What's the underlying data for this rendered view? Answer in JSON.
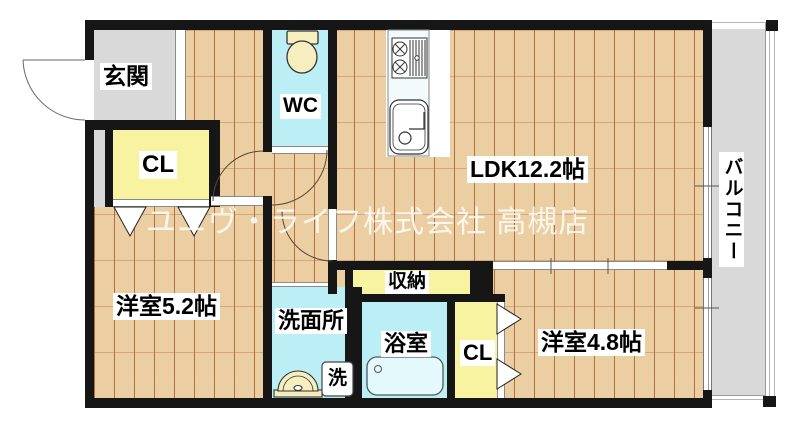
{
  "floorplan": {
    "type": "apartment-floor-plan",
    "watermark": "ユニヴ・ライフ株式会社 高槻店",
    "rooms": {
      "genkan": {
        "label": "玄関",
        "floor": "gray"
      },
      "wc": {
        "label": "WC",
        "floor": "cyan"
      },
      "ldk": {
        "label": "LDK12.2帖",
        "floor": "wood"
      },
      "closet1": {
        "label": "CL",
        "floor": "yellow"
      },
      "western_room1": {
        "label": "洋室5.2帖",
        "floor": "wood"
      },
      "storage": {
        "label": "収納",
        "floor": "yellow"
      },
      "senmenjo": {
        "label": "洗面所",
        "floor": "cyan"
      },
      "bathroom": {
        "label": "浴室",
        "floor": "cyan"
      },
      "laundry": {
        "label": "洗",
        "floor": "white"
      },
      "closet2": {
        "label": "CL",
        "floor": "yellow"
      },
      "western_room2": {
        "label": "洋室4.8帖",
        "floor": "wood"
      },
      "balcony": {
        "label": "バルコニー",
        "floor": "gray"
      }
    },
    "fixtures": [
      {
        "name": "entrance-door-swing"
      },
      {
        "name": "toilet"
      },
      {
        "name": "kitchen-stove"
      },
      {
        "name": "kitchen-sink"
      },
      {
        "name": "washbasin"
      },
      {
        "name": "washing-machine-pan"
      },
      {
        "name": "bathtub"
      },
      {
        "name": "folding-door-closet1"
      },
      {
        "name": "folding-door-closet2"
      },
      {
        "name": "door-swing-wc"
      },
      {
        "name": "door-swing-western-room1"
      },
      {
        "name": "door-swing-ldk"
      },
      {
        "name": "sliding-door-ldk-western-room2"
      },
      {
        "name": "sliding-window-balcony-ldk"
      },
      {
        "name": "sliding-window-balcony-western-room2"
      }
    ],
    "colors": {
      "wall": "#161616",
      "wood_floor": "#ebcfa2",
      "plank_line": "#a86030",
      "wet_room_cyan": "#bceef5",
      "closet_yellow": "#f8f3a0",
      "gray_area": "#d9d9d9",
      "fixture_cream": "#f6eebe",
      "watermark_white": "rgba(255,255,255,0.82)"
    }
  }
}
